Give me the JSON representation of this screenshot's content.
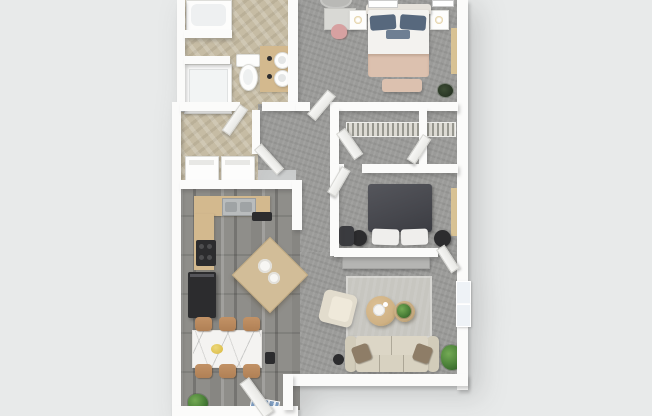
{
  "meta": {
    "description": "Top-down 3D rendered apartment floor plan, one-bedroom-plus-den style unit on light gray background",
    "canvas": {
      "width": 652,
      "height": 416
    },
    "visible_text": []
  },
  "palette": {
    "bg": "#e8eaea",
    "wall": "#fbfbfa",
    "carpet": "#9b9b99",
    "wood": "#8f8e8a",
    "tile": "#c6bca4",
    "rug": "#c7c6c0",
    "counter": "#d3b98e",
    "island": "#d2bd98",
    "marble": "#f4f3f1",
    "chair": "#b08055",
    "sofa": "#dcd6c6",
    "sofa_arm": "#d2ccba",
    "pillow_brown": "#8e7d67",
    "bed1_duvet": "#f3f2ef",
    "bed1_blush": "#dcc1af",
    "bed1_navy": "#57687d",
    "headboard": "#e6e2db",
    "bed2_duvet": "#46474d",
    "dark": "#2c2c2e",
    "console": "#b5b5b3",
    "coffee_table": "#cfb184",
    "plant": "#4a8038",
    "plant_dark": "#2f5b28",
    "gold": "#c9a54e",
    "pink": "#d7a1a1",
    "mat_blue": "#7d9cc0",
    "sill": "#d8c294",
    "window": "#eef2f6",
    "steel": "#b9bcbd"
  },
  "floorplan": {
    "view": "top-down-3d-render",
    "rooms": [
      {
        "id": "primary-bedroom",
        "floor": "carpet",
        "contents": [
          "bed-with-navy-pillows-and-blush-blanket",
          "foot-bench",
          "nightstand-left-with-lamp",
          "nightstand-right-with-lamp",
          "desk",
          "pink-chair",
          "round-rug",
          "corner-plant"
        ]
      },
      {
        "id": "bathroom",
        "floor": "tile",
        "contents": [
          "bathtub",
          "shower",
          "toilet",
          "double-sink-vanity"
        ]
      },
      {
        "id": "laundry-room",
        "floor": "tile",
        "contents": [
          "washer",
          "dryer"
        ]
      },
      {
        "id": "hallway-closets",
        "floor": "carpet",
        "contents": [
          "wire-shelf-closet-a",
          "wire-shelf-closet-b",
          "open-doors"
        ]
      },
      {
        "id": "bedroom-2",
        "floor": "carpet",
        "contents": [
          "charcoal-bed-white-pillows",
          "round-nightstand-left",
          "round-nightstand-right",
          "corner-chair"
        ]
      },
      {
        "id": "kitchen",
        "floor": "wood-plank",
        "contents": [
          "l-shaped-counter",
          "double-sink",
          "cooktop",
          "refrigerator",
          "angled-island-with-plates"
        ]
      },
      {
        "id": "dining-area",
        "floor": "wood-plank",
        "contents": [
          "marble-table",
          "six-tan-chairs",
          "yellow-bowl",
          "floor-plant"
        ]
      },
      {
        "id": "living-room",
        "floor": "carpet",
        "contents": [
          "media-console",
          "area-rug",
          "round-coffee-table-large",
          "round-coffee-table-small-with-plant",
          "cream-sofa-brown-pillows",
          "armchair",
          "floor-lamp",
          "potted-plant",
          "open-windows"
        ]
      },
      {
        "id": "entry",
        "floor": "wood-plank",
        "contents": [
          "open-entry-door",
          "blue-door-mat"
        ]
      }
    ]
  }
}
